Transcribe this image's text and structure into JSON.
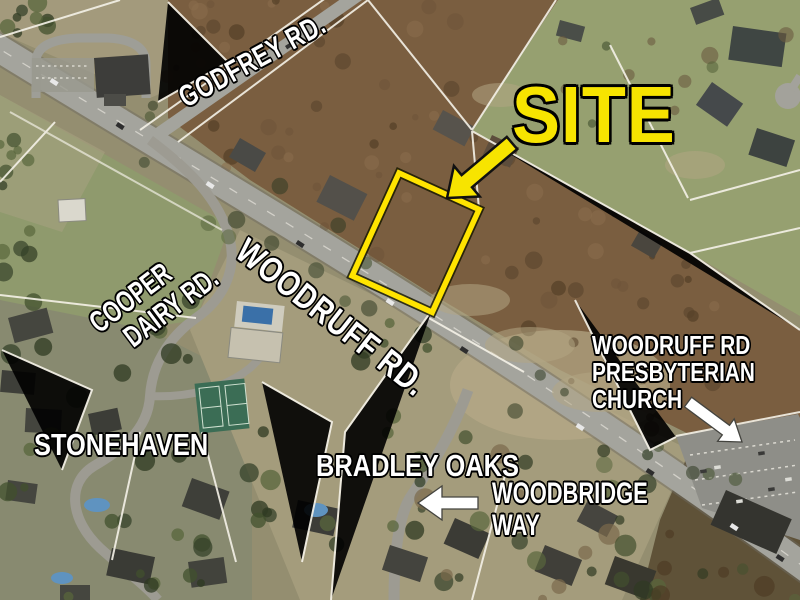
{
  "map": {
    "site": {
      "label": "SITE"
    },
    "roads": {
      "godfrey": {
        "label": "GODFREY RD."
      },
      "woodruff": {
        "label": "WOODRUFF RD."
      },
      "cooper_dairy": {
        "line1": "COOPER",
        "line2": "DAIRY RD."
      },
      "woodbridge": {
        "line1": "WOODBRIDGE",
        "line2": "WAY"
      }
    },
    "neighborhoods": {
      "stonehaven": {
        "label": "STONEHAVEN"
      },
      "bradley_oaks": {
        "label": "BRADLEY OAKS"
      }
    },
    "pois": {
      "church": {
        "line1": "WOODRUFF RD",
        "line2": "PRESBYTERIAN",
        "line3": "CHURCH"
      }
    },
    "colors": {
      "site_accent": "#f7e400",
      "parcel_outline": "#ffe400",
      "label_text": "#ffffff",
      "label_outline": "#000000",
      "callout_arrow_white": "#ffffff"
    }
  }
}
